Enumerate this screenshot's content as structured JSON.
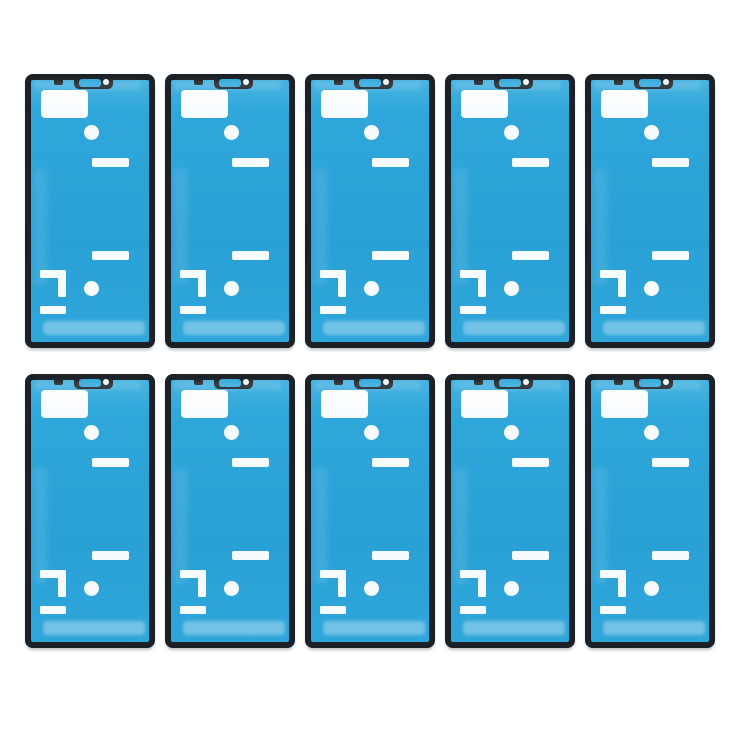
{
  "page": {
    "background": "#ffffff",
    "width": 750,
    "height": 750
  },
  "product_grid": {
    "rows": 2,
    "cols": 5,
    "item_count": 10,
    "item": {
      "name": "front-housing-adhesive-sticker",
      "colors": {
        "film_blue": "#2fa7db",
        "film_deep": "#2aa1d6",
        "film_light": "#4cb6e2",
        "frame_black": "#1c2127",
        "cutout_white": "#f6fbfe"
      },
      "cutout_features": [
        "earpiece-tab-cutline",
        "earpiece-window",
        "proximity-sensor-hole",
        "top-alignment-notch",
        "sensor-area-cutout",
        "front-camera-hole-cutout",
        "upper-slot-cutout",
        "lower-slot-cutout",
        "bracket-cutout-top",
        "bracket-cutout-side",
        "bracket-cutout-bottom",
        "home-button-hole-cutout"
      ]
    }
  }
}
